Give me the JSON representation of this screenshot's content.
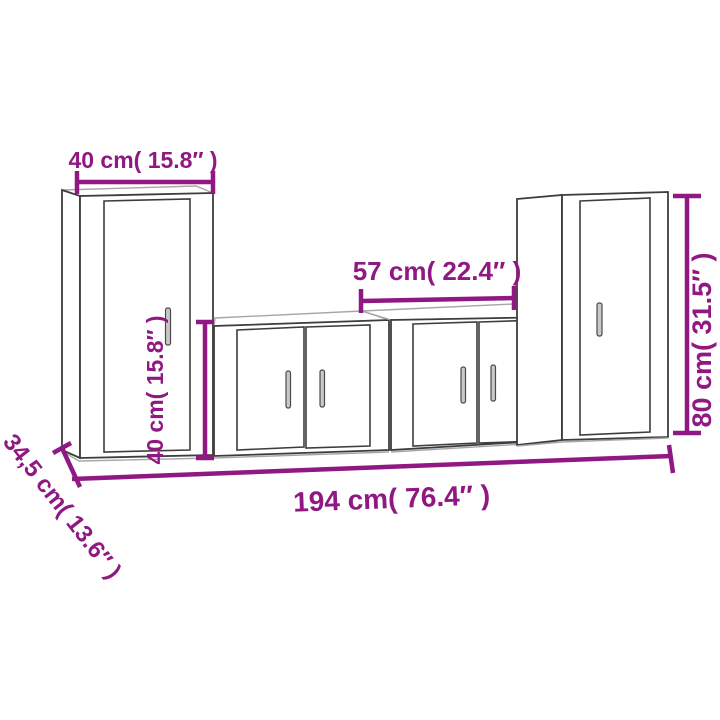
{
  "page": {
    "background": "#ffffff",
    "kind": "furniture dimension drawing"
  },
  "colors": {
    "dimension": "#8F1883",
    "outline": "#3d3d3d",
    "outline_light": "#a6a6a6",
    "handle_fill": "#c9c9c9",
    "handle_border": "#4a4a4a"
  },
  "dimensions": {
    "tall_cabinet_width": "40 cm( 15.8″ )",
    "low_cabinet_height": "40 cm( 15.8″ )",
    "low_cabinet_width": "57 cm( 22.4″ )",
    "tall_cabinet_height": "80 cm( 31.5″ )",
    "total_width": "194 cm( 76.4″ )",
    "depth": "34,5 cm( 13.6″ )"
  }
}
